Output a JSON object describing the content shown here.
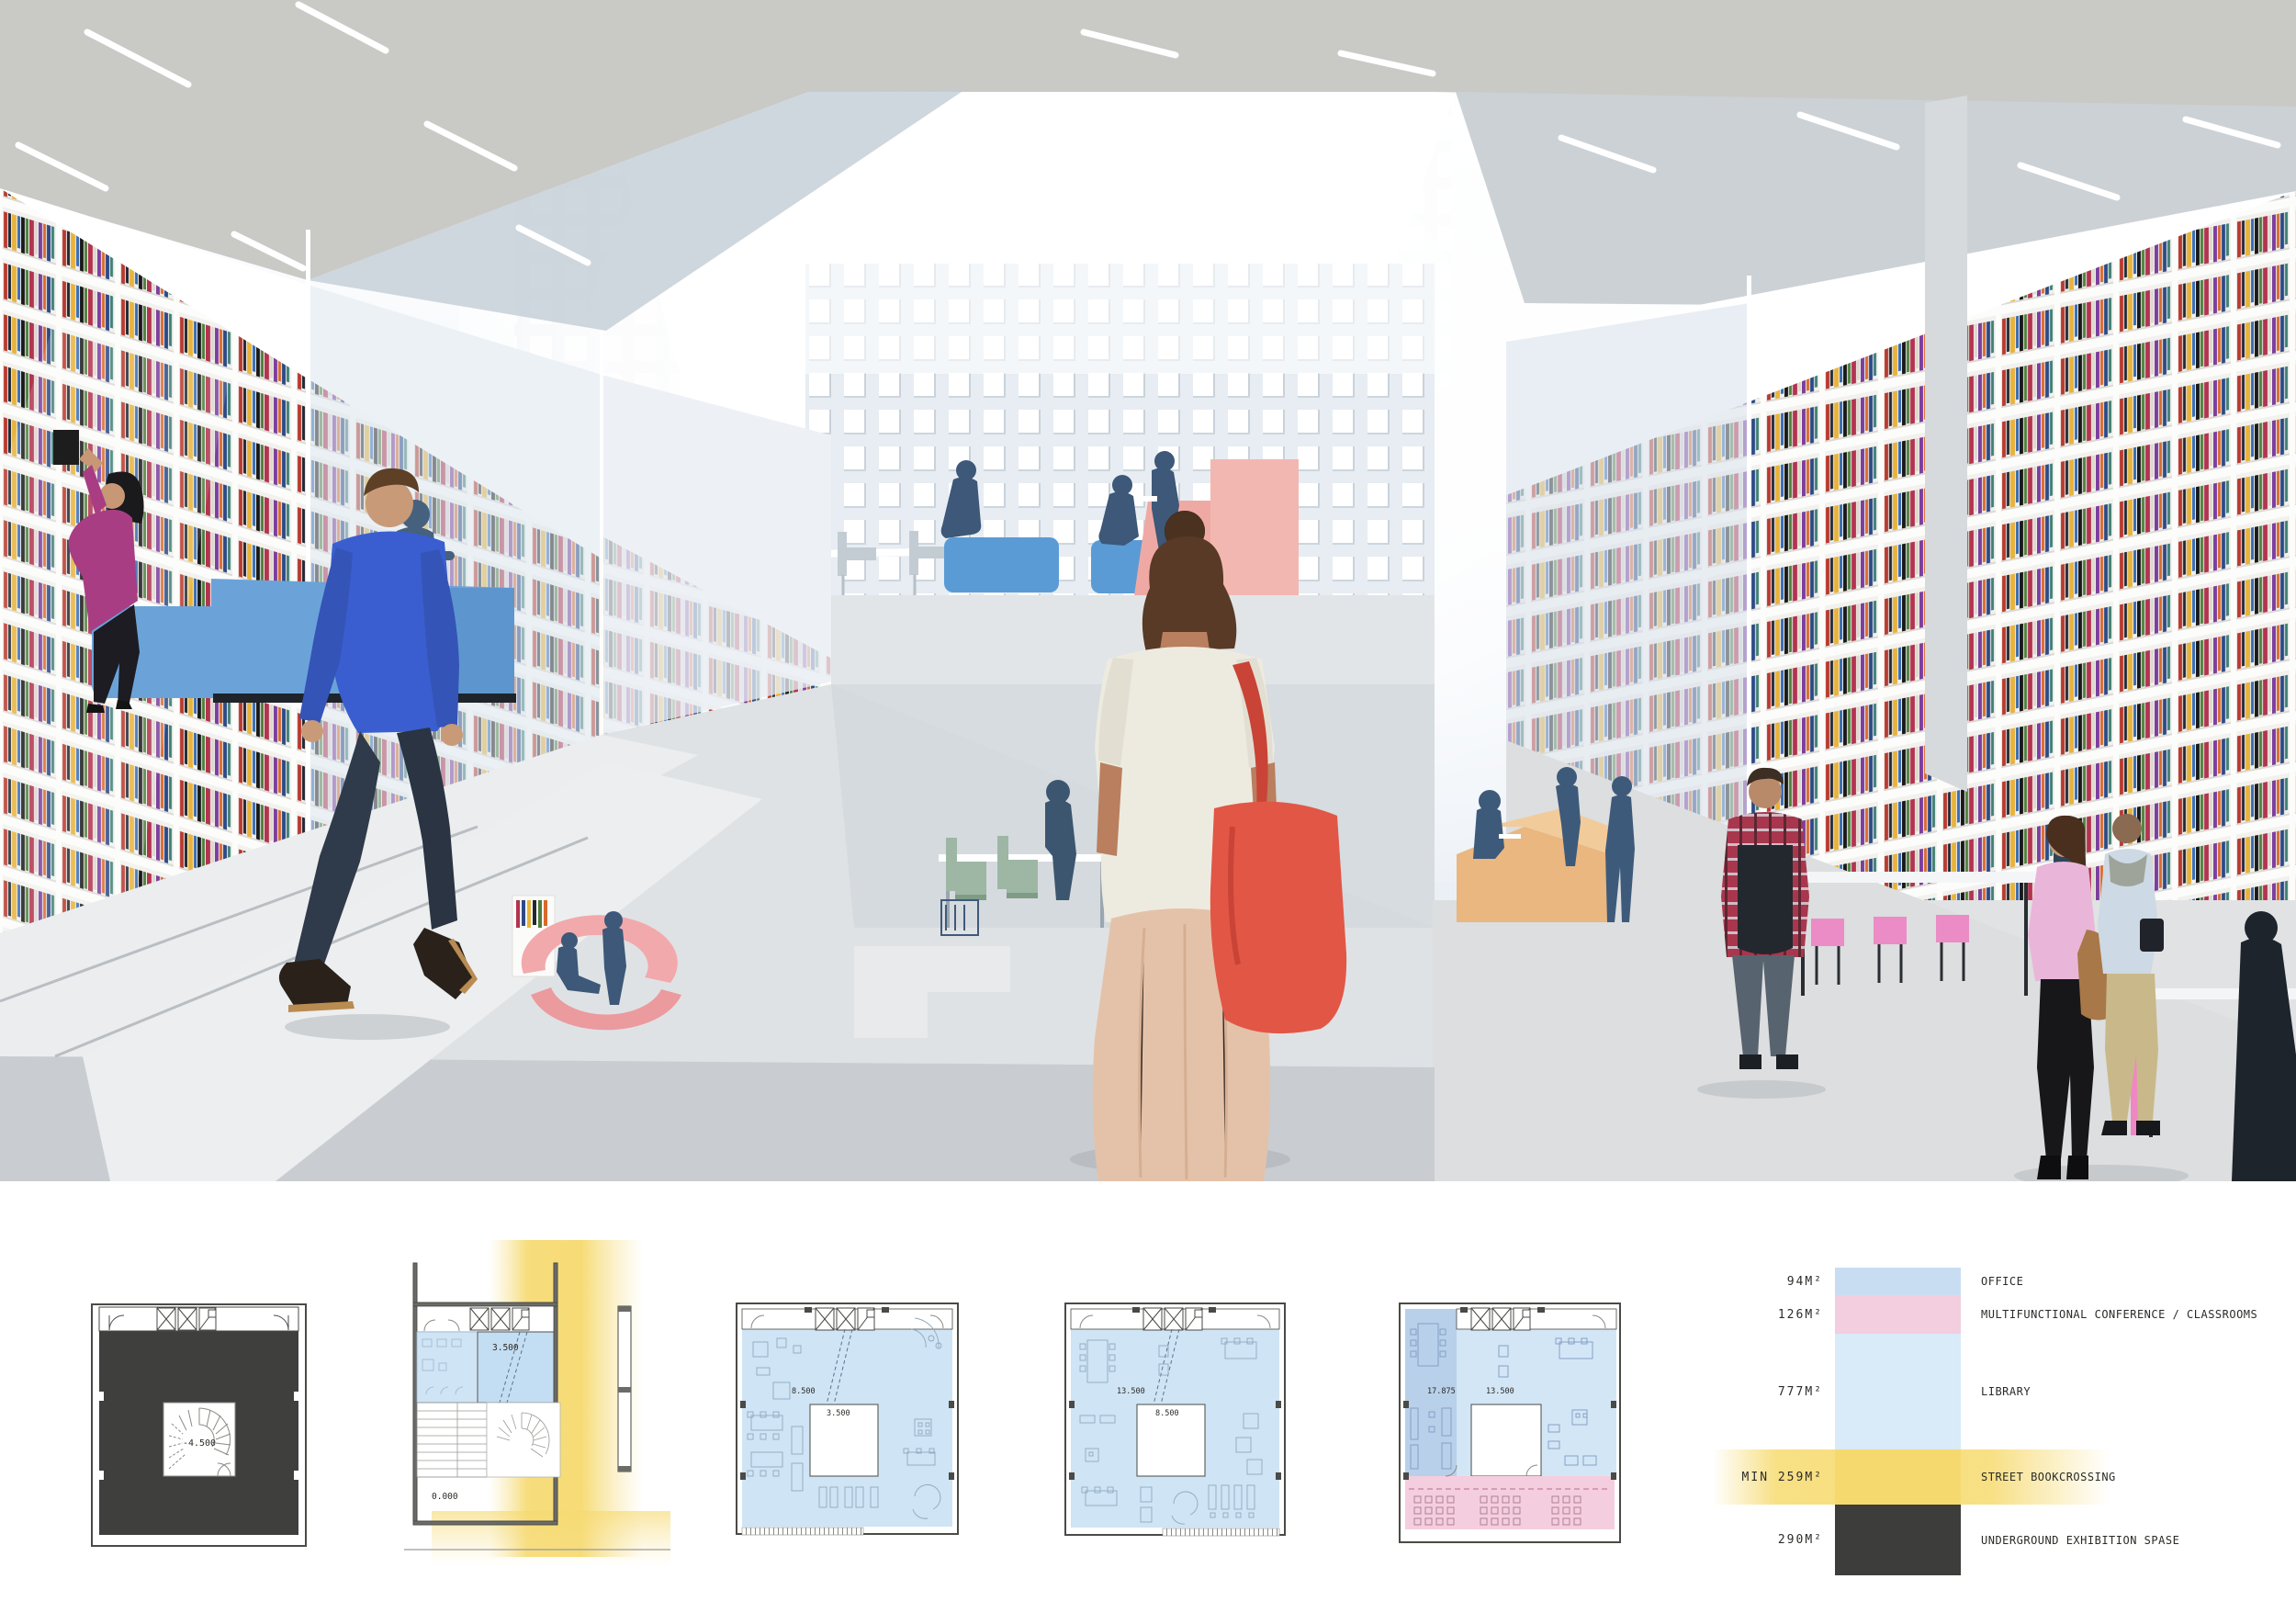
{
  "board": {
    "kind": "architecture competition presentation board",
    "sections": [
      "interior perspective rendering",
      "floor plans",
      "program area legend"
    ]
  },
  "legend": {
    "rows": [
      {
        "area": "94M²",
        "label": "OFFICE",
        "color": "#c9ddf2"
      },
      {
        "area": "126M²",
        "label": "MULTIFUNCTIONAL CONFERENCE / CLASSROOMS",
        "color": "#f2cede"
      },
      {
        "area": "777M²",
        "label": "LIBRARY",
        "color": "#d9eaf9"
      },
      {
        "area": "MIN 259M²",
        "label": "STREET BOOKCROSSING",
        "color": "#f7de7e"
      },
      {
        "area": "290M²",
        "label": "UNDERGROUND EXHIBITION SPASE",
        "color": "#3d3d3b"
      }
    ]
  },
  "plans": [
    {
      "id": "underground-exhibition-plan",
      "level_label": "-4.500"
    },
    {
      "id": "ground-level-section",
      "upper_label": "3.500",
      "ground_label": "0.000"
    },
    {
      "id": "level-one-plan",
      "main_label": "8.500",
      "void_label": "3.500"
    },
    {
      "id": "level-two-plan",
      "main_label": "13.500",
      "void_label": "8.500"
    },
    {
      "id": "level-three-plan",
      "office_label": "17.875",
      "main_label": "13.500"
    }
  ],
  "render": {
    "colors": {
      "concrete_ceiling": "#c9c9c6",
      "perforated_wall": "#e7edf2",
      "floor": "#ccd1d5",
      "sofa_blue": "#6ba3d9",
      "pouf_blue": "#5b9bd5",
      "bench_pink": "#f2a9ac",
      "steps_pink": "#efa9a4",
      "seat_orange": "#e9b77f",
      "chair_green": "#9db7a4",
      "stool_pink": "#eb8cc6",
      "silhouette_blue": "#3e5a7a",
      "shirt_blue": "#3a5ecf",
      "bag_red": "#e05545",
      "top_magenta": "#a83d84",
      "skirt_beige": "#e4c2a9",
      "plaid_red": "#a8374e",
      "blouse_pink": "#e9b6d9"
    },
    "book_spine_palette": [
      "#b83a2e",
      "#e8b33c",
      "#222833",
      "#4e7e3c",
      "#7c3f9e",
      "#d96a2c",
      "#3a6db3",
      "#ddd8cd",
      "#191919",
      "#b23450",
      "#3f7f74",
      "#e0d23e",
      "#704426",
      "#2d4a87"
    ]
  }
}
